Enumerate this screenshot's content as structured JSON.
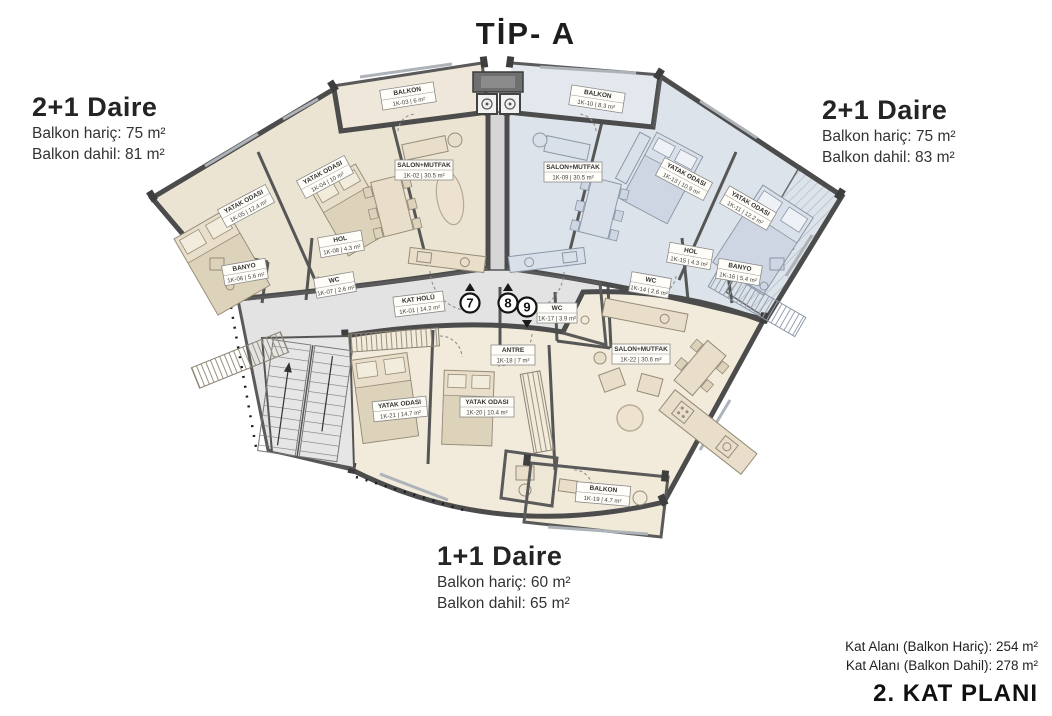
{
  "title": "TİP- A",
  "units": {
    "left": {
      "name": "2+1 Daire",
      "line1": "Balkon hariç: 75 m²",
      "line2": "Balkon dahil: 81 m²",
      "number": "7"
    },
    "right": {
      "name": "2+1 Daire",
      "line1": "Balkon hariç: 75 m²",
      "line2": "Balkon dahil: 83 m²",
      "number": "8"
    },
    "bottom": {
      "name": "1+1 Daire",
      "line1": "Balkon hariç: 60 m²",
      "line2": "Balkon dahil: 65 m²",
      "number": "9"
    }
  },
  "footer": {
    "line1": "Kat Alanı (Balkon Hariç): 254 m²",
    "line2": "Kat Alanı (Balkon Dahil): 278 m²",
    "plan_label": "2. KAT PLANI"
  },
  "rooms": {
    "kat_holu": {
      "name": "KAT HOLÜ",
      "area": "1K-01 | 14.2 m²"
    },
    "l_salon": {
      "name": "SALON+MUTFAK",
      "area": "1K-02 | 30.5 m²"
    },
    "l_balkon": {
      "name": "BALKON",
      "area": "1K-03 | 6 m²"
    },
    "l_bed_b": {
      "name": "YATAK ODASI",
      "area": "1K-04 | 10 m²"
    },
    "l_bed_a": {
      "name": "YATAK ODASI",
      "area": "1K-05 | 12.4 m²"
    },
    "l_banyo": {
      "name": "BANYO",
      "area": "1K-06 | 5.6 m²"
    },
    "l_wc": {
      "name": "WC",
      "area": "1K-07 | 2.6 m²"
    },
    "l_hol": {
      "name": "HOL",
      "area": "1K-08 | 4.3 m²"
    },
    "r_salon": {
      "name": "SALON+MUTFAK",
      "area": "1K-09 | 30.5 m²"
    },
    "r_balkon": {
      "name": "BALKON",
      "area": "1K-10 | 8.3 m²"
    },
    "r_bed_b": {
      "name": "YATAK ODASI",
      "area": "1K-11 | 12.2 m²"
    },
    "r_bed_a": {
      "name": "YATAK ODASI",
      "area": "1K-13 | 10.9 m²"
    },
    "r_wc": {
      "name": "WC",
      "area": "1K-14 | 2.6 m²"
    },
    "r_hol": {
      "name": "HOL",
      "area": "1K-15 | 4.3 m²"
    },
    "r_banyo": {
      "name": "BANYO",
      "area": "1K-16 | 5.4 m²"
    },
    "b_wc": {
      "name": "WC",
      "area": "1K-17 | 3.9 m²"
    },
    "b_antre": {
      "name": "ANTRE",
      "area": "1K-18 | 7 m²"
    },
    "b_balkon": {
      "name": "BALKON",
      "area": "1K-19 | 4.7 m²"
    },
    "b_bed_a": {
      "name": "YATAK ODASI",
      "area": "1K-20 | 10.4 m²"
    },
    "b_bed_b": {
      "name": "YATAK ODASI",
      "area": "1K-21 | 14.7 m²"
    },
    "b_salon": {
      "name": "SALON+MUTFAK",
      "area": "1K-22 | 30.6 m²"
    }
  },
  "colors": {
    "unit_left": "#ece4d3",
    "unit_right": "#dde3ea",
    "unit_bottom": "#f2ebdb",
    "corridor": "#e3e3e3",
    "wall": "#4c4c4c"
  }
}
